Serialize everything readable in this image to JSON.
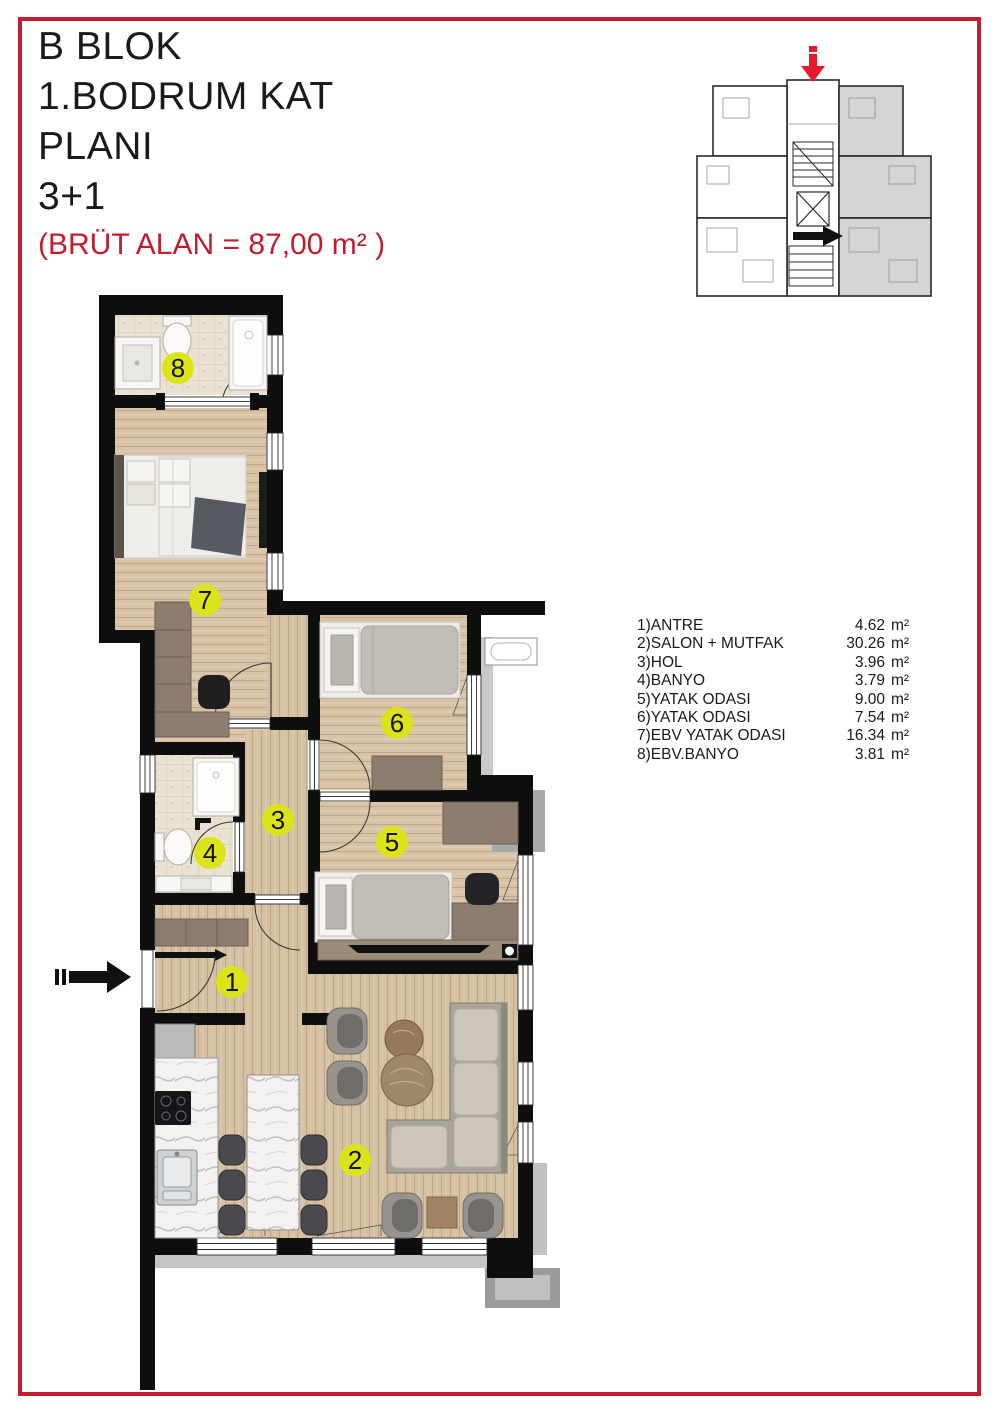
{
  "title": {
    "lines": [
      "B BLOK",
      "1.BODRUM KAT",
      "PLANI",
      "3+1"
    ],
    "area_note": "(BRÜT ALAN = 87,00 m² )"
  },
  "rooms": [
    {
      "no": "1",
      "legend_label": "1)ANTRE",
      "area": "4.62",
      "unit": "m²"
    },
    {
      "no": "2",
      "legend_label": "2)SALON + MUTFAK",
      "area": "30.26",
      "unit": "m²"
    },
    {
      "no": "3",
      "legend_label": "3)HOL",
      "area": "3.96",
      "unit": "m²"
    },
    {
      "no": "4",
      "legend_label": "4)BANYO",
      "area": "3.79",
      "unit": "m²"
    },
    {
      "no": "5",
      "legend_label": "5)YATAK ODASI",
      "area": "9.00",
      "unit": "m²"
    },
    {
      "no": "6",
      "legend_label": "6)YATAK ODASI",
      "area": "7.54",
      "unit": "m²"
    },
    {
      "no": "7",
      "legend_label": "7)EBV YATAK ODASI",
      "area": "16.34",
      "unit": "m²"
    },
    {
      "no": "8",
      "legend_label": "8)EBV.BANYO",
      "area": "3.81",
      "unit": "m²"
    }
  ],
  "colors": {
    "frame_red": "#be1e2d",
    "area_note_red": "#be1e2d",
    "room_badge_yellow": "#dce318",
    "wall_black": "#0e0e0e",
    "wood_floor": "#d9c3a6",
    "bath_floor": "#ebe3d1",
    "furniture_wood": "#8c7d6f",
    "exterior_gray": "#c6c6c6",
    "keyplan_highlight_gray": "#d5d5d5",
    "keyplan_entry_arrow_red": "#e8192c"
  }
}
